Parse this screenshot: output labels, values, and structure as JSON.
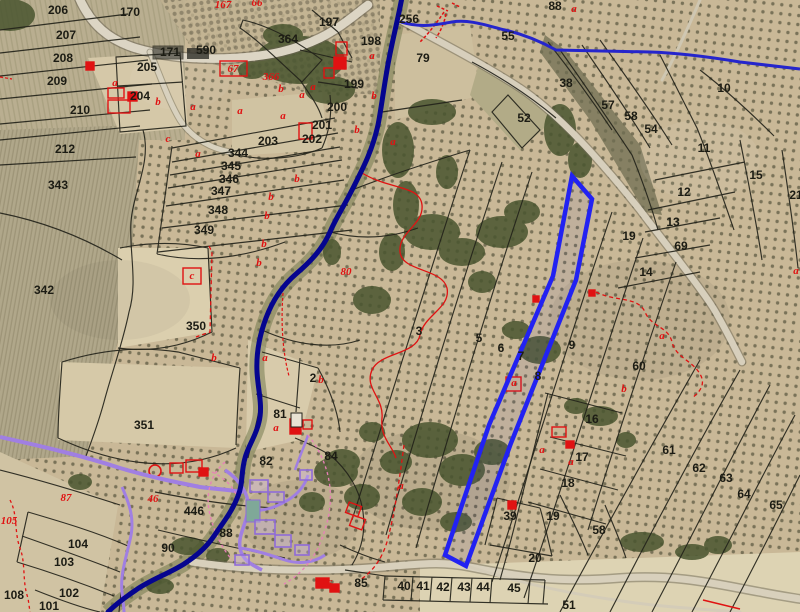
{
  "map": {
    "type": "cadastral-aerial-map",
    "description": "aerial orthophoto with cadastral parcel overlay, blue hydrography and selected parcel",
    "colors": {
      "parcel_line": "#23231a",
      "label_black": "#1c1c14",
      "label_red": "#e01212",
      "river_blue": "#05058f",
      "boundary_blue": "#2525cc",
      "selection_blue": "#2222f2",
      "urban_purple": "#a07fe2",
      "path_pink": "#e87fb8",
      "road_fill": "#d9d2c0",
      "ground": "#c9b897"
    },
    "labels": [
      {
        "t": "170",
        "x": 130,
        "y": 16
      },
      {
        "t": "206",
        "x": 58,
        "y": 14
      },
      {
        "t": "207",
        "x": 66,
        "y": 39
      },
      {
        "t": "208",
        "x": 63,
        "y": 62
      },
      {
        "t": "209",
        "x": 57,
        "y": 85
      },
      {
        "t": "210",
        "x": 80,
        "y": 114
      },
      {
        "t": "171",
        "x": 170,
        "y": 56
      },
      {
        "t": "590",
        "x": 206,
        "y": 54
      },
      {
        "t": "205",
        "x": 147,
        "y": 71
      },
      {
        "t": "204",
        "x": 140,
        "y": 100
      },
      {
        "t": "203",
        "x": 268,
        "y": 145
      },
      {
        "t": "202",
        "x": 312,
        "y": 143
      },
      {
        "t": "201",
        "x": 322,
        "y": 129
      },
      {
        "t": "200",
        "x": 337,
        "y": 111
      },
      {
        "t": "199",
        "x": 354,
        "y": 88
      },
      {
        "t": "198",
        "x": 371,
        "y": 45
      },
      {
        "t": "197",
        "x": 329,
        "y": 26
      },
      {
        "t": "364",
        "x": 288,
        "y": 43
      },
      {
        "t": "79",
        "x": 423,
        "y": 62
      },
      {
        "t": "256",
        "x": 409,
        "y": 23
      },
      {
        "t": "212",
        "x": 65,
        "y": 153
      },
      {
        "t": "343",
        "x": 58,
        "y": 189
      },
      {
        "t": "342",
        "x": 44,
        "y": 294
      },
      {
        "t": "344",
        "x": 238,
        "y": 157
      },
      {
        "t": "345",
        "x": 231,
        "y": 170
      },
      {
        "t": "346",
        "x": 229,
        "y": 183
      },
      {
        "t": "347",
        "x": 221,
        "y": 195
      },
      {
        "t": "348",
        "x": 218,
        "y": 214
      },
      {
        "t": "349",
        "x": 204,
        "y": 234
      },
      {
        "t": "350",
        "x": 196,
        "y": 330
      },
      {
        "t": "351",
        "x": 144,
        "y": 429
      },
      {
        "t": "88",
        "x": 555,
        "y": 10
      },
      {
        "t": "55",
        "x": 508,
        "y": 40
      },
      {
        "t": "38",
        "x": 566,
        "y": 87
      },
      {
        "t": "10",
        "x": 724,
        "y": 92
      },
      {
        "t": "52",
        "x": 524,
        "y": 122
      },
      {
        "t": "57",
        "x": 608,
        "y": 109
      },
      {
        "t": "58",
        "x": 631,
        "y": 120
      },
      {
        "t": "54",
        "x": 651,
        "y": 133
      },
      {
        "t": "11",
        "x": 704,
        "y": 152
      },
      {
        "t": "15",
        "x": 756,
        "y": 179
      },
      {
        "t": "12",
        "x": 684,
        "y": 196
      },
      {
        "t": "13",
        "x": 673,
        "y": 226
      },
      {
        "t": "69",
        "x": 681,
        "y": 250
      },
      {
        "t": "14",
        "x": 646,
        "y": 276
      },
      {
        "t": "19",
        "x": 629,
        "y": 240
      },
      {
        "t": "21",
        "x": 796,
        "y": 199
      },
      {
        "t": "3",
        "x": 419,
        "y": 335
      },
      {
        "t": "5",
        "x": 479,
        "y": 342
      },
      {
        "t": "6",
        "x": 501,
        "y": 352
      },
      {
        "t": "7",
        "x": 521,
        "y": 360
      },
      {
        "t": "8",
        "x": 538,
        "y": 380
      },
      {
        "t": "9",
        "x": 572,
        "y": 349
      },
      {
        "t": "60",
        "x": 639,
        "y": 370
      },
      {
        "t": "2",
        "x": 313,
        "y": 382
      },
      {
        "t": "81",
        "x": 280,
        "y": 418
      },
      {
        "t": "16",
        "x": 592,
        "y": 423
      },
      {
        "t": "17",
        "x": 582,
        "y": 461
      },
      {
        "t": "18",
        "x": 568,
        "y": 487
      },
      {
        "t": "19",
        "x": 553,
        "y": 520
      },
      {
        "t": "61",
        "x": 669,
        "y": 454
      },
      {
        "t": "62",
        "x": 699,
        "y": 472
      },
      {
        "t": "63",
        "x": 726,
        "y": 482
      },
      {
        "t": "64",
        "x": 744,
        "y": 498
      },
      {
        "t": "65",
        "x": 776,
        "y": 509
      },
      {
        "t": "39",
        "x": 510,
        "y": 520
      },
      {
        "t": "20",
        "x": 535,
        "y": 562
      },
      {
        "t": "58",
        "x": 599,
        "y": 534
      },
      {
        "t": "82",
        "x": 266,
        "y": 465
      },
      {
        "t": "84",
        "x": 331,
        "y": 460
      },
      {
        "t": "88",
        "x": 226,
        "y": 537
      },
      {
        "t": "90",
        "x": 168,
        "y": 552
      },
      {
        "t": "446",
        "x": 194,
        "y": 515
      },
      {
        "t": "104",
        "x": 78,
        "y": 548
      },
      {
        "t": "103",
        "x": 64,
        "y": 566
      },
      {
        "t": "102",
        "x": 69,
        "y": 597
      },
      {
        "t": "101",
        "x": 49,
        "y": 610
      },
      {
        "t": "108",
        "x": 14,
        "y": 599
      },
      {
        "t": "85",
        "x": 361,
        "y": 587
      },
      {
        "t": "40",
        "x": 404,
        "y": 590
      },
      {
        "t": "41",
        "x": 423,
        "y": 590
      },
      {
        "t": "42",
        "x": 443,
        "y": 591
      },
      {
        "t": "43",
        "x": 464,
        "y": 591
      },
      {
        "t": "44",
        "x": 483,
        "y": 591
      },
      {
        "t": "45",
        "x": 514,
        "y": 592
      },
      {
        "t": "51",
        "x": 569,
        "y": 609
      },
      {
        "t": "167",
        "x": 223,
        "y": 8,
        "c": "r"
      },
      {
        "t": "66",
        "x": 257,
        "y": 6,
        "c": "r"
      },
      {
        "t": "67",
        "x": 233,
        "y": 72,
        "c": "r"
      },
      {
        "t": "366",
        "x": 271,
        "y": 80,
        "c": "r"
      },
      {
        "t": "80",
        "x": 346,
        "y": 275,
        "c": "r",
        "fs": 12
      },
      {
        "t": "87",
        "x": 66,
        "y": 501,
        "c": "r",
        "fs": 12
      },
      {
        "t": "46",
        "x": 153,
        "y": 502,
        "c": "r"
      },
      {
        "t": "105",
        "x": 9,
        "y": 524,
        "c": "r"
      },
      {
        "t": "366",
        "x": 324,
        "y": 587,
        "c": "r"
      },
      {
        "t": "a",
        "x": 115,
        "y": 86,
        "c": "r"
      },
      {
        "t": "b",
        "x": 158,
        "y": 105,
        "c": "r"
      },
      {
        "t": "a",
        "x": 193,
        "y": 110,
        "c": "r"
      },
      {
        "t": "a",
        "x": 240,
        "y": 114,
        "c": "r"
      },
      {
        "t": "a",
        "x": 283,
        "y": 119,
        "c": "r"
      },
      {
        "t": "a",
        "x": 302,
        "y": 98,
        "c": "r"
      },
      {
        "t": "a",
        "x": 313,
        "y": 90,
        "c": "r"
      },
      {
        "t": "b",
        "x": 281,
        "y": 92,
        "c": "r"
      },
      {
        "t": "c",
        "x": 168,
        "y": 142,
        "c": "r"
      },
      {
        "t": "a",
        "x": 198,
        "y": 157,
        "c": "r"
      },
      {
        "t": "b",
        "x": 357,
        "y": 133,
        "c": "r"
      },
      {
        "t": "a",
        "x": 393,
        "y": 145,
        "c": "r"
      },
      {
        "t": "a",
        "x": 372,
        "y": 59,
        "c": "r"
      },
      {
        "t": "b",
        "x": 374,
        "y": 99,
        "c": "r"
      },
      {
        "t": "b",
        "x": 297,
        "y": 182,
        "c": "r"
      },
      {
        "t": "b",
        "x": 271,
        "y": 200,
        "c": "r"
      },
      {
        "t": "b",
        "x": 267,
        "y": 219,
        "c": "r"
      },
      {
        "t": "b",
        "x": 264,
        "y": 247,
        "c": "r"
      },
      {
        "t": "b",
        "x": 259,
        "y": 266,
        "c": "r"
      },
      {
        "t": "c",
        "x": 192,
        "y": 279,
        "c": "r"
      },
      {
        "t": "b",
        "x": 214,
        "y": 361,
        "c": "r"
      },
      {
        "t": "a",
        "x": 265,
        "y": 361,
        "c": "r"
      },
      {
        "t": "b",
        "x": 321,
        "y": 383,
        "c": "r"
      },
      {
        "t": "a",
        "x": 276,
        "y": 431,
        "c": "r"
      },
      {
        "t": "a",
        "x": 401,
        "y": 489,
        "c": "r"
      },
      {
        "t": "a",
        "x": 662,
        "y": 339,
        "c": "r"
      },
      {
        "t": "b",
        "x": 624,
        "y": 392,
        "c": "r"
      },
      {
        "t": "a",
        "x": 514,
        "y": 386,
        "c": "r"
      },
      {
        "t": "a",
        "x": 571,
        "y": 465,
        "c": "r"
      },
      {
        "t": "a",
        "x": 542,
        "y": 453,
        "c": "r"
      },
      {
        "t": "a",
        "x": 574,
        "y": 12,
        "c": "r"
      },
      {
        "t": "a",
        "x": 796,
        "y": 274,
        "c": "r"
      }
    ],
    "red_boxes": [
      {
        "x": 220,
        "y": 61,
        "w": 27,
        "h": 15
      },
      {
        "x": 183,
        "y": 268,
        "w": 18,
        "h": 16
      },
      {
        "x": 506,
        "y": 377,
        "w": 15,
        "h": 14
      }
    ],
    "buildings": [
      {
        "x": 86,
        "y": 62,
        "w": 8,
        "h": 8,
        "f": 1
      },
      {
        "x": 108,
        "y": 88,
        "w": 16,
        "h": 10,
        "f": 0
      },
      {
        "x": 108,
        "y": 100,
        "w": 22,
        "h": 13,
        "f": 0
      },
      {
        "x": 128,
        "y": 92,
        "w": 9,
        "h": 9,
        "f": 1
      },
      {
        "x": 299,
        "y": 123,
        "w": 13,
        "h": 16,
        "f": 0
      },
      {
        "x": 336,
        "y": 42,
        "w": 11,
        "h": 13,
        "f": 0
      },
      {
        "x": 334,
        "y": 57,
        "w": 12,
        "h": 12,
        "f": 1
      },
      {
        "x": 324,
        "y": 68,
        "w": 10,
        "h": 10,
        "f": 0
      },
      {
        "x": 290,
        "y": 419,
        "w": 11,
        "h": 15,
        "f": 1
      },
      {
        "x": 303,
        "y": 420,
        "w": 9,
        "h": 9,
        "f": 0
      },
      {
        "x": 170,
        "y": 463,
        "w": 13,
        "h": 10,
        "f": 0
      },
      {
        "x": 186,
        "y": 460,
        "w": 16,
        "h": 12,
        "f": 0
      },
      {
        "x": 199,
        "y": 468,
        "w": 9,
        "h": 8,
        "f": 1
      },
      {
        "x": 347,
        "y": 504,
        "w": 13,
        "h": 11,
        "f": 0,
        "r": 20
      },
      {
        "x": 351,
        "y": 517,
        "w": 13,
        "h": 11,
        "f": 0,
        "r": 20
      },
      {
        "x": 316,
        "y": 578,
        "w": 13,
        "h": 10,
        "f": 1
      },
      {
        "x": 330,
        "y": 584,
        "w": 9,
        "h": 8,
        "f": 1
      },
      {
        "x": 552,
        "y": 427,
        "w": 14,
        "h": 10,
        "f": 0
      },
      {
        "x": 566,
        "y": 441,
        "w": 8,
        "h": 7,
        "f": 1
      },
      {
        "x": 533,
        "y": 296,
        "w": 6,
        "h": 6,
        "f": 1
      },
      {
        "x": 589,
        "y": 290,
        "w": 6,
        "h": 6,
        "f": 1
      },
      {
        "x": 508,
        "y": 501,
        "w": 8,
        "h": 8,
        "f": 1
      }
    ],
    "well_circle": {
      "cx": 155,
      "cy": 471,
      "r": 6
    },
    "selection": {
      "name": "selected-parcel",
      "stroke": "#2222f2"
    }
  }
}
